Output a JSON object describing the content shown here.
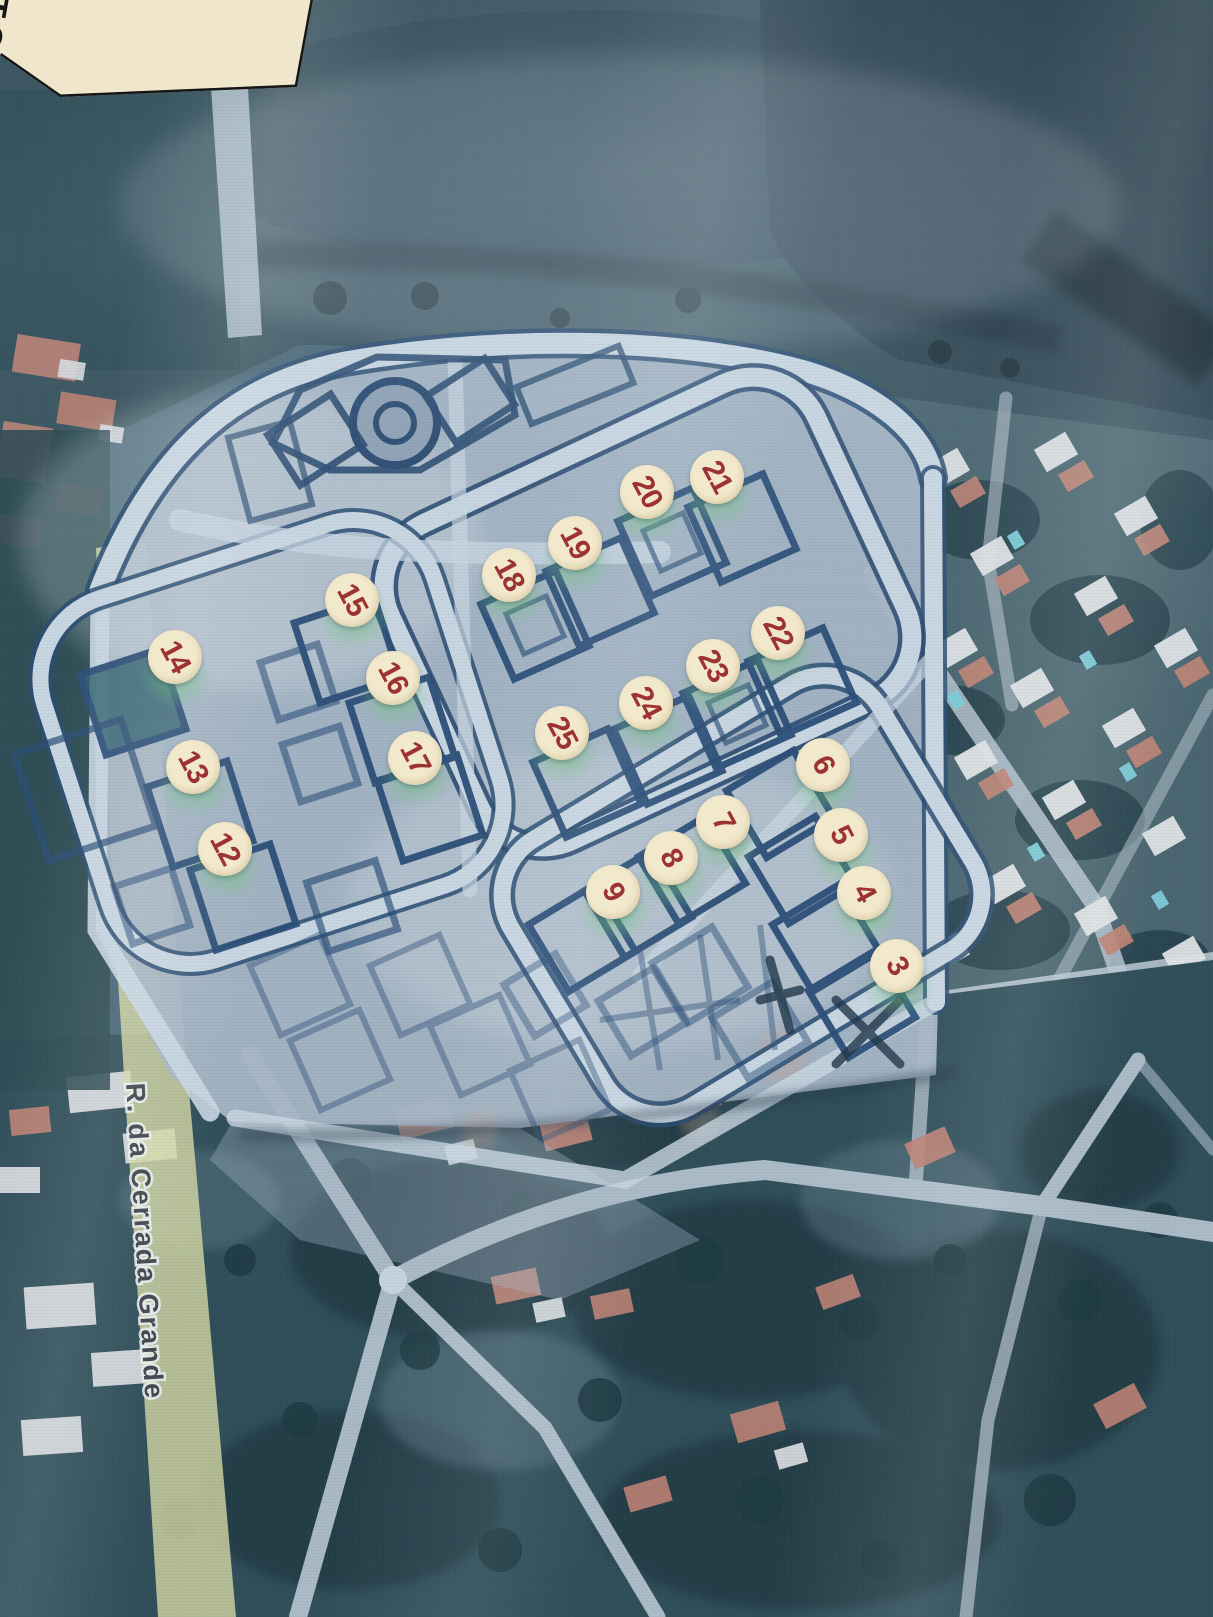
{
  "map": {
    "street_label": "R. da Cerrada Grande",
    "corner_text": "TO"
  },
  "markers": [
    {
      "label": "3",
      "x": 897,
      "y": 966
    },
    {
      "label": "4",
      "x": 864,
      "y": 893
    },
    {
      "label": "5",
      "x": 841,
      "y": 835
    },
    {
      "label": "6",
      "x": 823,
      "y": 765
    },
    {
      "label": "7",
      "x": 723,
      "y": 822
    },
    {
      "label": "8",
      "x": 671,
      "y": 858
    },
    {
      "label": "9",
      "x": 613,
      "y": 892
    },
    {
      "label": "12",
      "x": 225,
      "y": 849
    },
    {
      "label": "13",
      "x": 193,
      "y": 767
    },
    {
      "label": "14",
      "x": 175,
      "y": 657
    },
    {
      "label": "15",
      "x": 352,
      "y": 600
    },
    {
      "label": "16",
      "x": 393,
      "y": 678
    },
    {
      "label": "17",
      "x": 415,
      "y": 758
    },
    {
      "label": "18",
      "x": 509,
      "y": 575
    },
    {
      "label": "19",
      "x": 575,
      "y": 543
    },
    {
      "label": "20",
      "x": 647,
      "y": 492
    },
    {
      "label": "21",
      "x": 717,
      "y": 477
    },
    {
      "label": "22",
      "x": 778,
      "y": 633
    },
    {
      "label": "23",
      "x": 713,
      "y": 666
    },
    {
      "label": "24",
      "x": 646,
      "y": 703
    },
    {
      "label": "25",
      "x": 562,
      "y": 733
    }
  ],
  "colors": {
    "marker_fill": "#f2e8cb",
    "marker_number": "#9c3332",
    "plan_fill": "#a7b6c6",
    "plan_line": "#2c4f78",
    "road_light": "#c9d7e2",
    "highlight_green": "#6fc57c",
    "yellow_road": "#d4d8a4",
    "legend_box": "#efe6cc"
  }
}
